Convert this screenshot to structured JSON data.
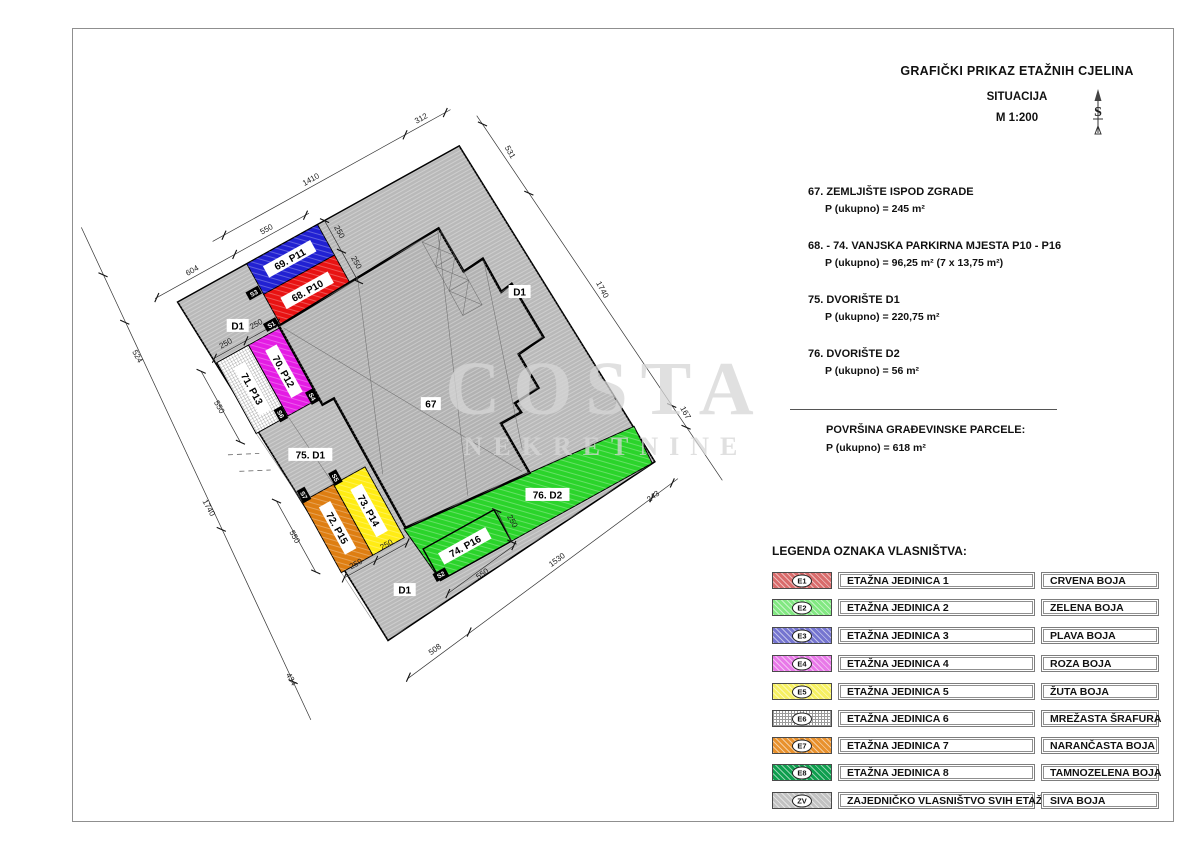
{
  "header": {
    "title": "GRAFIČKI PRIKAZ ETAŽNIH CJELINA",
    "subtitle": "SITUACIJA",
    "scale": "M 1:200",
    "north_letter": "S"
  },
  "areas": {
    "items": [
      {
        "title": "67. ZEMLJIŠTE ISPOD ZGRADE",
        "area": "P (ukupno) = 245 m²"
      },
      {
        "title": "68. - 74. VANJSKA PARKIRNA MJESTA P10 - P16",
        "area": "P (ukupno) = 96,25 m²   (7 x 13,75 m²)"
      },
      {
        "title": "75. DVORIŠTE D1",
        "area": "P (ukupno) = 220,75 m²"
      },
      {
        "title": "76. DVORIŠTE D2",
        "area": "P (ukupno) = 56 m²"
      }
    ],
    "total_title": "POVRŠINA GRAĐEVINSKE PARCELE:",
    "total_area": "P (ukupno) = 618 m²"
  },
  "legend": {
    "title": "LEGENDA OZNAKA VLASNIŠTVA:",
    "rows": [
      {
        "code": "E1",
        "label": "ETAŽNA JEDINICA 1",
        "color_label": "CRVENA BOJA",
        "swatch": "#d96c6c",
        "pattern": "hatch"
      },
      {
        "code": "E2",
        "label": "ETAŽNA JEDINICA 2",
        "color_label": "ZELENA BOJA",
        "swatch": "#82e882",
        "pattern": "hatch"
      },
      {
        "code": "E3",
        "label": "ETAŽNA JEDINICA 3",
        "color_label": "PLAVA BOJA",
        "swatch": "#7575d0",
        "pattern": "hatch"
      },
      {
        "code": "E4",
        "label": "ETAŽNA JEDINICA 4",
        "color_label": "ROZA BOJA",
        "swatch": "#e879e8",
        "pattern": "hatch"
      },
      {
        "code": "E5",
        "label": "ETAŽNA JEDINICA 5",
        "color_label": "ŽUTA BOJA",
        "swatch": "#f6f062",
        "pattern": "hatch"
      },
      {
        "code": "E6",
        "label": "ETAŽNA JEDINICA 6",
        "color_label": "MREŽASTA ŠRAFURA",
        "swatch": "#ffffff",
        "pattern": "mesh"
      },
      {
        "code": "E7",
        "label": "ETAŽNA JEDINICA 7",
        "color_label": "NARANČASTA BOJA",
        "swatch": "#e8912d",
        "pattern": "hatch"
      },
      {
        "code": "E8",
        "label": "ETAŽNA JEDINICA 8",
        "color_label": "TAMNOZELENA BOJA",
        "swatch": "#0e9e4e",
        "pattern": "hatch"
      },
      {
        "code": "ZV",
        "label": "ZAJEDNIČKO VLASNIŠTVO SVIH ETAŽA",
        "color_label": "SIVA BOJA",
        "swatch": "#c2c2c2",
        "pattern": "hatch"
      }
    ]
  },
  "watermark": {
    "line1": "COSTA",
    "line2": "NEKRETNINE"
  },
  "plan": {
    "stalls": [
      {
        "label": "69. P11",
        "color": "#2121d2"
      },
      {
        "label": "68. P10",
        "color": "#e81313"
      },
      {
        "label": "70. P12",
        "color": "#e41ce4"
      },
      {
        "label": "71. P13",
        "color": "#ffffff"
      },
      {
        "label": "73. P14",
        "color": "#ffec14"
      },
      {
        "label": "72. P15",
        "color": "#de7e12"
      },
      {
        "label": "74. P16",
        "color": "none"
      },
      {
        "label": "76. D2",
        "color": "#2bd42b"
      }
    ],
    "zone_labels": [
      "D1",
      "D1",
      "D1",
      "75. D1",
      "67"
    ],
    "s_markers": [
      "S3",
      "S1",
      "S4",
      "S6",
      "S5",
      "S7",
      "S2"
    ],
    "dims": [
      "524",
      "1740",
      "434",
      "550",
      "550",
      "250",
      "250",
      "250",
      "250",
      "250",
      "250",
      "1410",
      "312",
      "604",
      "550",
      "531",
      "1740",
      "167",
      "508",
      "1530",
      "243",
      "550",
      "250"
    ]
  }
}
